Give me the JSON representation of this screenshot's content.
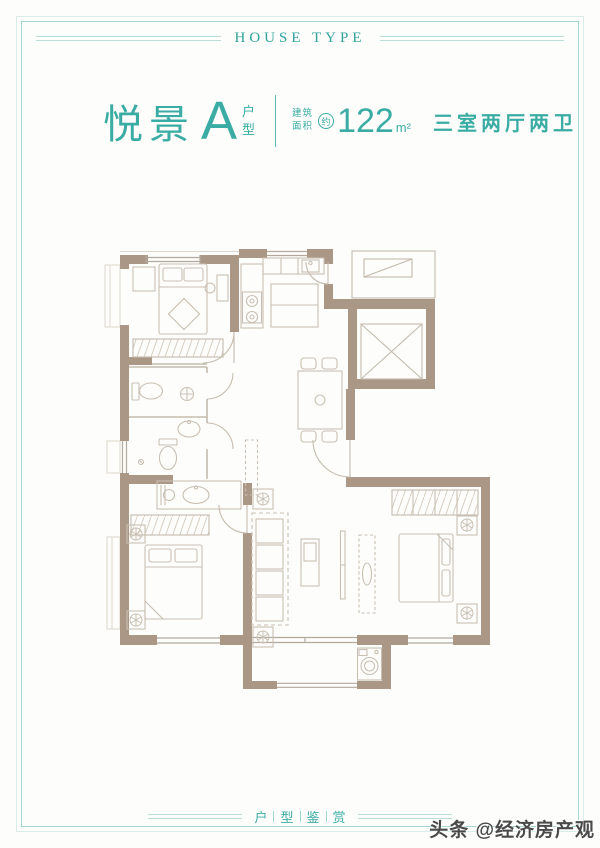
{
  "header": {
    "title": "HOUSE TYPE"
  },
  "title_block": {
    "project_name": "悦景",
    "unit_letter": "A",
    "unit_chars": [
      "户",
      "型"
    ],
    "area_label_top": "建筑",
    "area_label_bottom": "面积",
    "area_approx": "约",
    "area_value": "122",
    "area_unit": "m²",
    "layout_description": "三室两厅两卫"
  },
  "footer": {
    "chars": [
      "户",
      "型",
      "鉴",
      "赏"
    ]
  },
  "watermark": {
    "text": "头条 @经济房产观"
  },
  "colors": {
    "accent_teal": "#3aaca4",
    "wall_taupe": "#ab9786",
    "furniture_line": "#c9c0b3",
    "frame_outer": "#d9ecea",
    "frame_inner": "#a3d6d1"
  }
}
